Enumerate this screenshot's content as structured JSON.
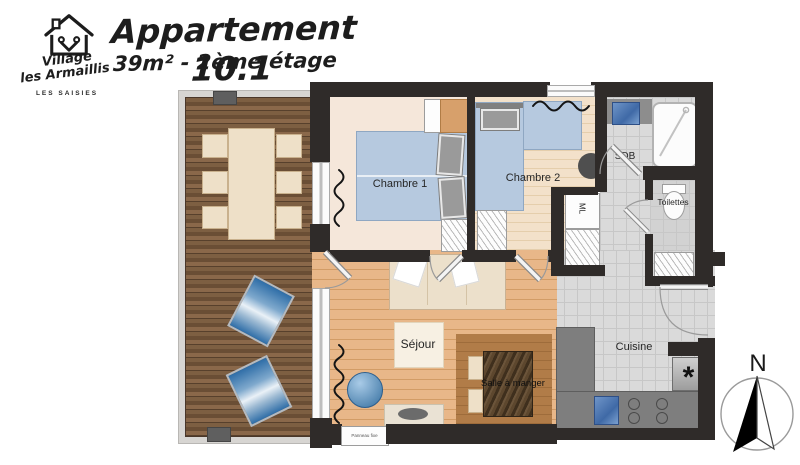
{
  "header": {
    "logo": {
      "word1": "Village",
      "word2": "les Armaillis",
      "word3": "LES SAISIES"
    },
    "title": "Appartement 10.1",
    "subtitle": "39m² - 2ème étage"
  },
  "plan": {
    "labels": {
      "chambre1": "Chambre 1",
      "chambre2": "Chambre 2",
      "sdb": "SDB",
      "toilettes": "Toilettes",
      "ml": "ML",
      "sejour": "Séjour",
      "salle_a_manger": "Salle à manger",
      "cuisine": "Cuisine",
      "window_note": "Panneau fixe",
      "entry_star": "*",
      "north": "N"
    },
    "colors": {
      "wall": "#2f2b29",
      "tile": "#dadada",
      "bed": "#b6c9df",
      "deck-wood": "#75573c",
      "sejour-wood": "#e5b181",
      "chambre1-floor": "#f5e7da",
      "chambre2-floor": "#f2dfc7",
      "counter": "#7e7e7e",
      "platform": "#ad7a46",
      "accent-green": "#2fa32a",
      "lounge-blue": "#2f6ea8"
    }
  }
}
